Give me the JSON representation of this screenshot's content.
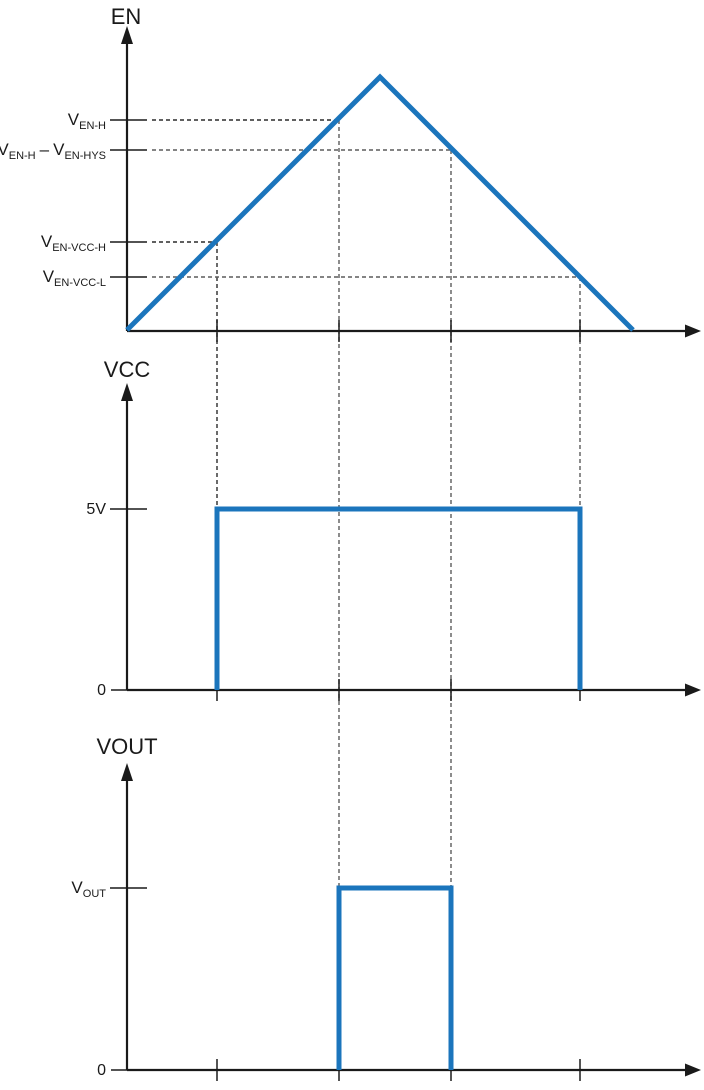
{
  "colors": {
    "waveform_blue": "#1B75BC",
    "axis": "#1a1a1a",
    "guide_dash": "#5c5c5c",
    "guide_dash_dark": "#2b2b2b"
  },
  "panels": {
    "en": {
      "title": "EN",
      "thresholds": {
        "ven_h": {
          "base": "V",
          "sub": "EN-H"
        },
        "ven_h_minus_hys": {
          "base1": "V",
          "sub1": "EN-H",
          "operator": "–",
          "base2": "V",
          "sub2": "EN-HYS"
        },
        "ven_vcc_h": {
          "base": "V",
          "sub": "EN-VCC-H"
        },
        "ven_vcc_l": {
          "base": "V",
          "sub": "EN-VCC-L"
        }
      }
    },
    "vcc": {
      "title": "VCC",
      "levels": {
        "high": "5V",
        "zero": "0"
      }
    },
    "vout": {
      "title": "VOUT",
      "levels": {
        "high_base": "V",
        "high_sub": "OUT",
        "zero": "0"
      }
    }
  }
}
